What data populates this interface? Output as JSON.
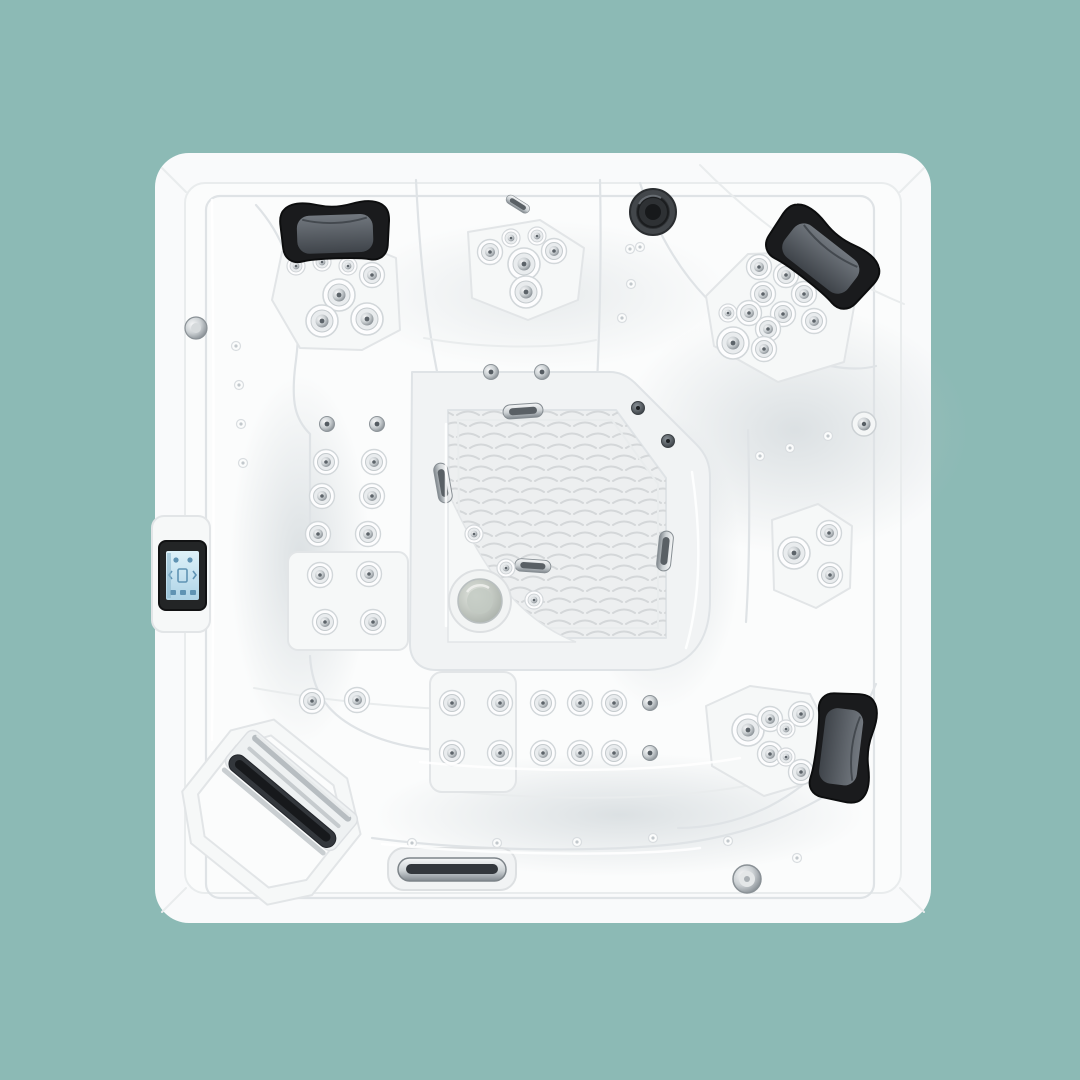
{
  "scene": {
    "type": "product-photo",
    "subject": "hot-tub-top-view",
    "description": "Top-down product photo of a white square hot tub spa on a plain teal background, with three dark grey headrest pillows, clusters of chrome hydrotherapy jets, a touchscreen control panel on the left rim, a corner waterfall spout, a textured footwell with chrome drain, and a chrome front vent slot.",
    "background_color": "#8cbab5"
  },
  "colors": {
    "background": "#8cbab5",
    "shell": "#f9fafb",
    "interior": "#fbfcfc",
    "panel": "#f6f8f8",
    "panel_edge": "#e2e5e7",
    "bench": "#f1f3f4",
    "line": "#dfe3e6",
    "line_soft": "#e9eced",
    "floor": "#edeff0",
    "floor_wave": "#d4d7d9",
    "headrest_dark": "#1a1b1d",
    "headrest_grey_hi": "#72787f",
    "headrest_grey_lo": "#3f444a",
    "chrome_hi": "#f6f7f8",
    "chrome_mid": "#ccd1d4",
    "chrome_lo": "#80878d",
    "darkchrome_hi": "#8b9298",
    "darkchrome_lo": "#33383d",
    "knob": "#43474b",
    "lcd_hi": "#dff2f9",
    "lcd_lo": "#aed3e6",
    "lcd_icon": "#5f93b3",
    "slot_dark": "#33373c",
    "drain_hi": "#e3e7e1",
    "drain_lo": "#a7aea7",
    "shadow": "#bcc5ca"
  },
  "features": {
    "headrests": {
      "count": 3,
      "positions": [
        "top-left",
        "top-right",
        "bottom-right"
      ],
      "color": "#1a1b1d"
    },
    "jet_clusters": [
      {
        "name": "top-left-seat",
        "jets": 7
      },
      {
        "name": "top-center-seat",
        "jets": 6
      },
      {
        "name": "top-right-corner-seat",
        "jets": 11
      },
      {
        "name": "left-backrest",
        "jets": 14
      },
      {
        "name": "bottom-lounger-backrest",
        "jets": 12
      },
      {
        "name": "bottom-right-corner-seat",
        "jets": 7
      },
      {
        "name": "right-seat",
        "jets": 4
      },
      {
        "name": "footwell-edge",
        "jets": 3
      }
    ],
    "control_panel": {
      "type": "touchscreen",
      "location": "left-rim",
      "screen_color": "#dff2f9"
    },
    "waterfall_spout": {
      "location": "bottom-left-corner",
      "finish": "white-and-chrome"
    },
    "speaker_knob": {
      "location": "top-center",
      "color": "#43474b"
    },
    "floor_drain": {
      "location": "footwell",
      "finish": "chrome"
    },
    "front_vent": {
      "location": "bottom-center",
      "finish": "chrome"
    }
  }
}
